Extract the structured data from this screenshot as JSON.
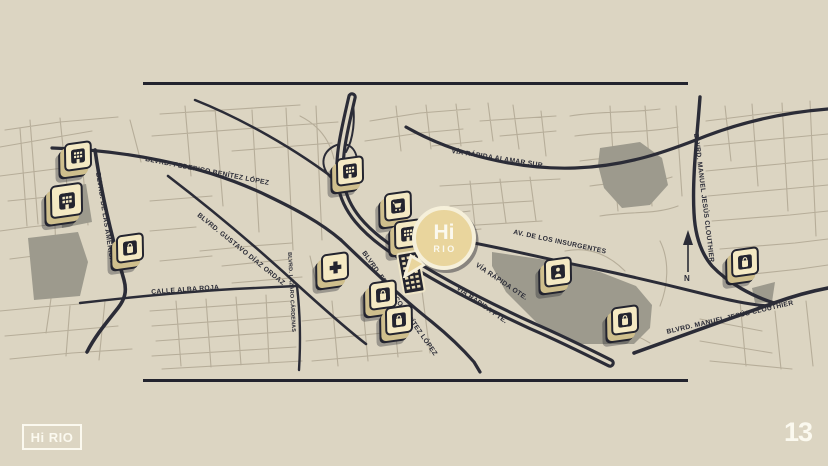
{
  "slide": {
    "page_number": "13"
  },
  "brand": {
    "logo_text": "Hi RIO",
    "callout_line1": "Hi",
    "callout_line2": "RIO"
  },
  "map": {
    "north_label": "N",
    "street_labels": [
      {
        "id": "federico-benitez-west",
        "text": "BLVRD.  FEDERICO BENÍTEZ LÓPEZ"
      },
      {
        "id": "de-las-americas",
        "text": "BLVRD. DE LAS AMÉRICAS"
      },
      {
        "id": "gustavo-diaz-ordaz",
        "text": "BLVRD.  GUSTAVO DÍAZ ORDAZ"
      },
      {
        "id": "calle-alba-roja",
        "text": "CALLE ALBA ROJA"
      },
      {
        "id": "lazaro-cardenas",
        "text": "BLVRD.  LÁZARO CÁRDENAS"
      },
      {
        "id": "federico-benitez-center",
        "text": "BLVRD.  FEDERICO BENÍTEZ LÓPEZ"
      },
      {
        "id": "via-rapida-alamar-sur",
        "text": "VÍA RÁPIDA ALAMAR SUR"
      },
      {
        "id": "av-de-los-insurgentes",
        "text": "AV. DE LOS INSURGENTES"
      },
      {
        "id": "via-rapida-ote",
        "text": "VÍA RÁPIDA OTE."
      },
      {
        "id": "via-rapida-pte",
        "text": "VÍA RÁPIDA PTE."
      },
      {
        "id": "manuel-jesus-clouthier-north",
        "text": "BLVRD.  MANUEL JESÚS CLOUTHIER"
      },
      {
        "id": "manuel-jesus-clouthier-south",
        "text": "BLVRD.  MANUEL JESÚS CLOUTHIER"
      }
    ],
    "markers": [
      {
        "icon": "building-icon"
      },
      {
        "icon": "building-icon"
      },
      {
        "icon": "bag-icon"
      },
      {
        "icon": "building-icon"
      },
      {
        "icon": "cart-icon"
      },
      {
        "icon": "building-icon"
      },
      {
        "icon": "medical-cross-icon"
      },
      {
        "icon": "bag-icon"
      },
      {
        "icon": "bag-icon"
      },
      {
        "icon": "person-icon"
      },
      {
        "icon": "bag-icon"
      },
      {
        "icon": "bag-icon"
      }
    ]
  },
  "colors": {
    "background": "#dcd5c2",
    "ink_navy": "#2b2c37",
    "street_light": "#b6ad99",
    "zone_gray": "#9d9a8d",
    "marker_cream": "#f4e9c3",
    "callout_yellow": "#e9d59d",
    "text_light": "#fbf9ef"
  }
}
